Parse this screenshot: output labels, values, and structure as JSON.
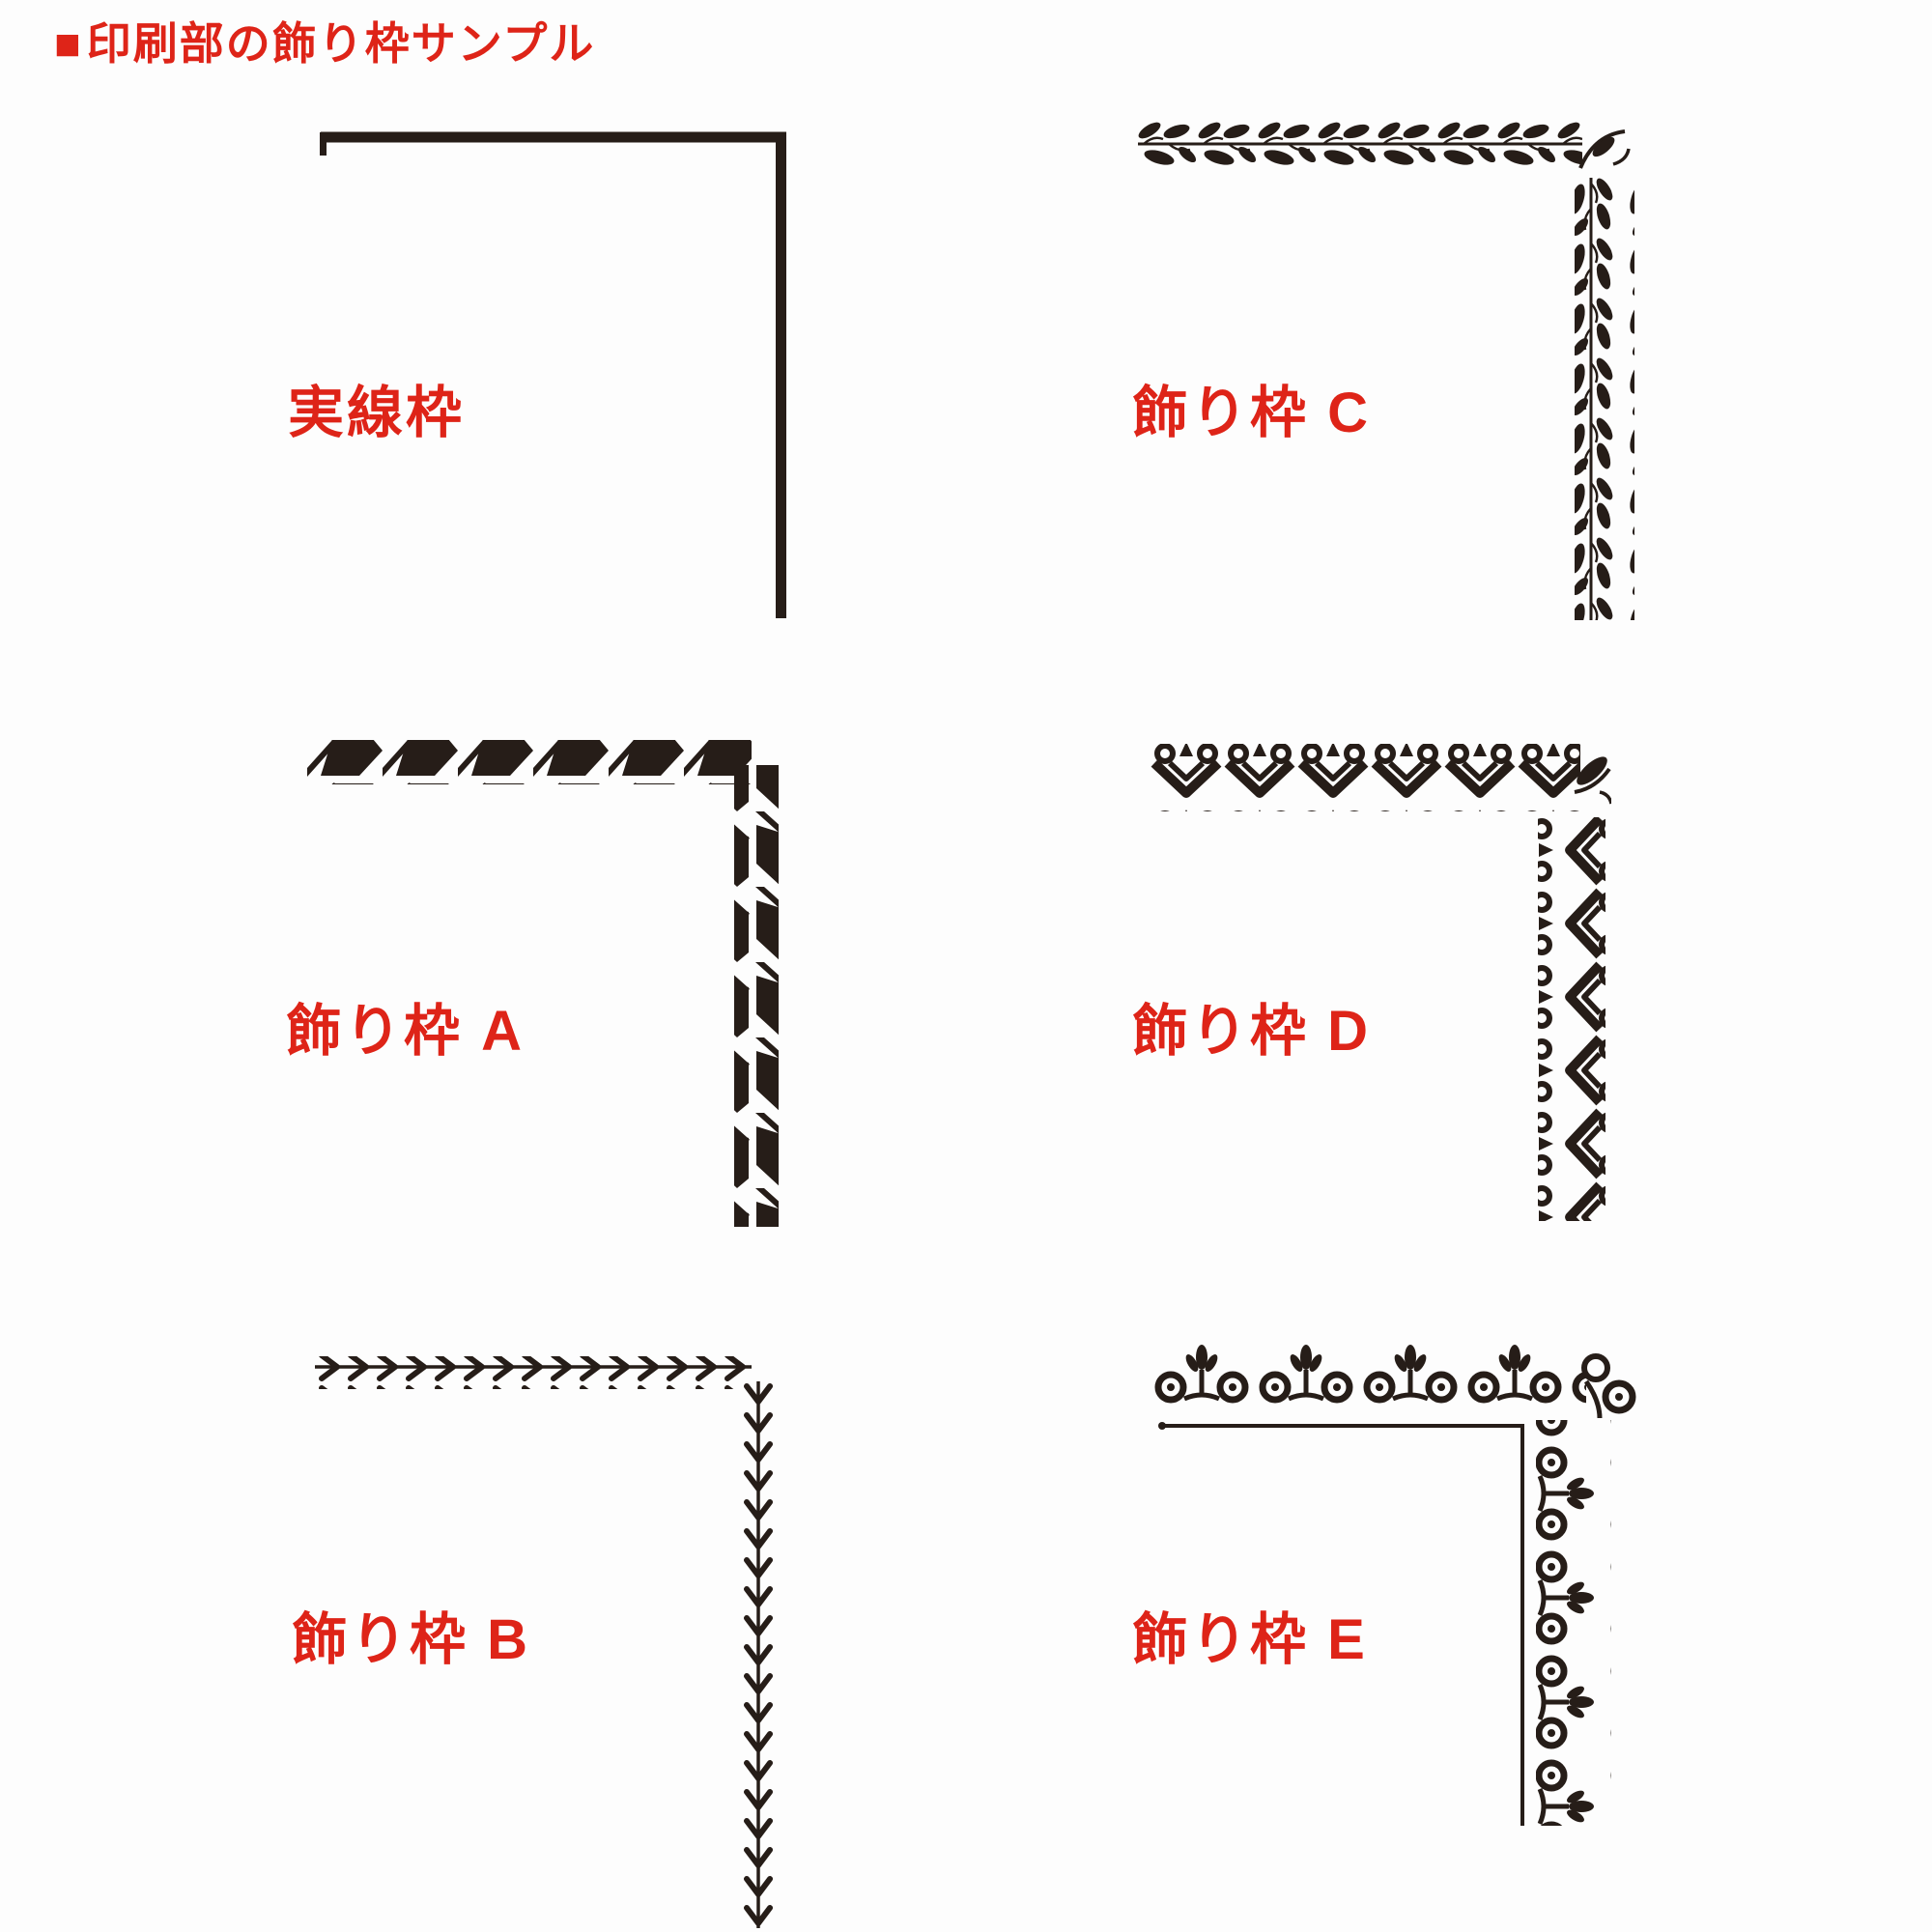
{
  "colors": {
    "background": "#fdfdfd",
    "accent_red": "#de2418",
    "ink_black": "#261d18"
  },
  "header": {
    "bullet": "■",
    "title": "印刷部の飾り枠サンプル"
  },
  "samples": [
    {
      "label": "実線枠",
      "ornament": "solid-line-frame",
      "position": "top-left"
    },
    {
      "label": "飾り枠 C",
      "ornament": "leaf-vine-frame",
      "position": "top-right"
    },
    {
      "label": "飾り枠 A",
      "ornament": "ribbon-zigzag-frame",
      "position": "middle-left"
    },
    {
      "label": "飾り枠 D",
      "ornament": "heart-scroll-frame",
      "position": "middle-right"
    },
    {
      "label": "飾り枠 B",
      "ornament": "chevron-vine-frame",
      "position": "bottom-left"
    },
    {
      "label": "飾り枠 E",
      "ornament": "floral-scroll-frame",
      "position": "bottom-right"
    }
  ]
}
